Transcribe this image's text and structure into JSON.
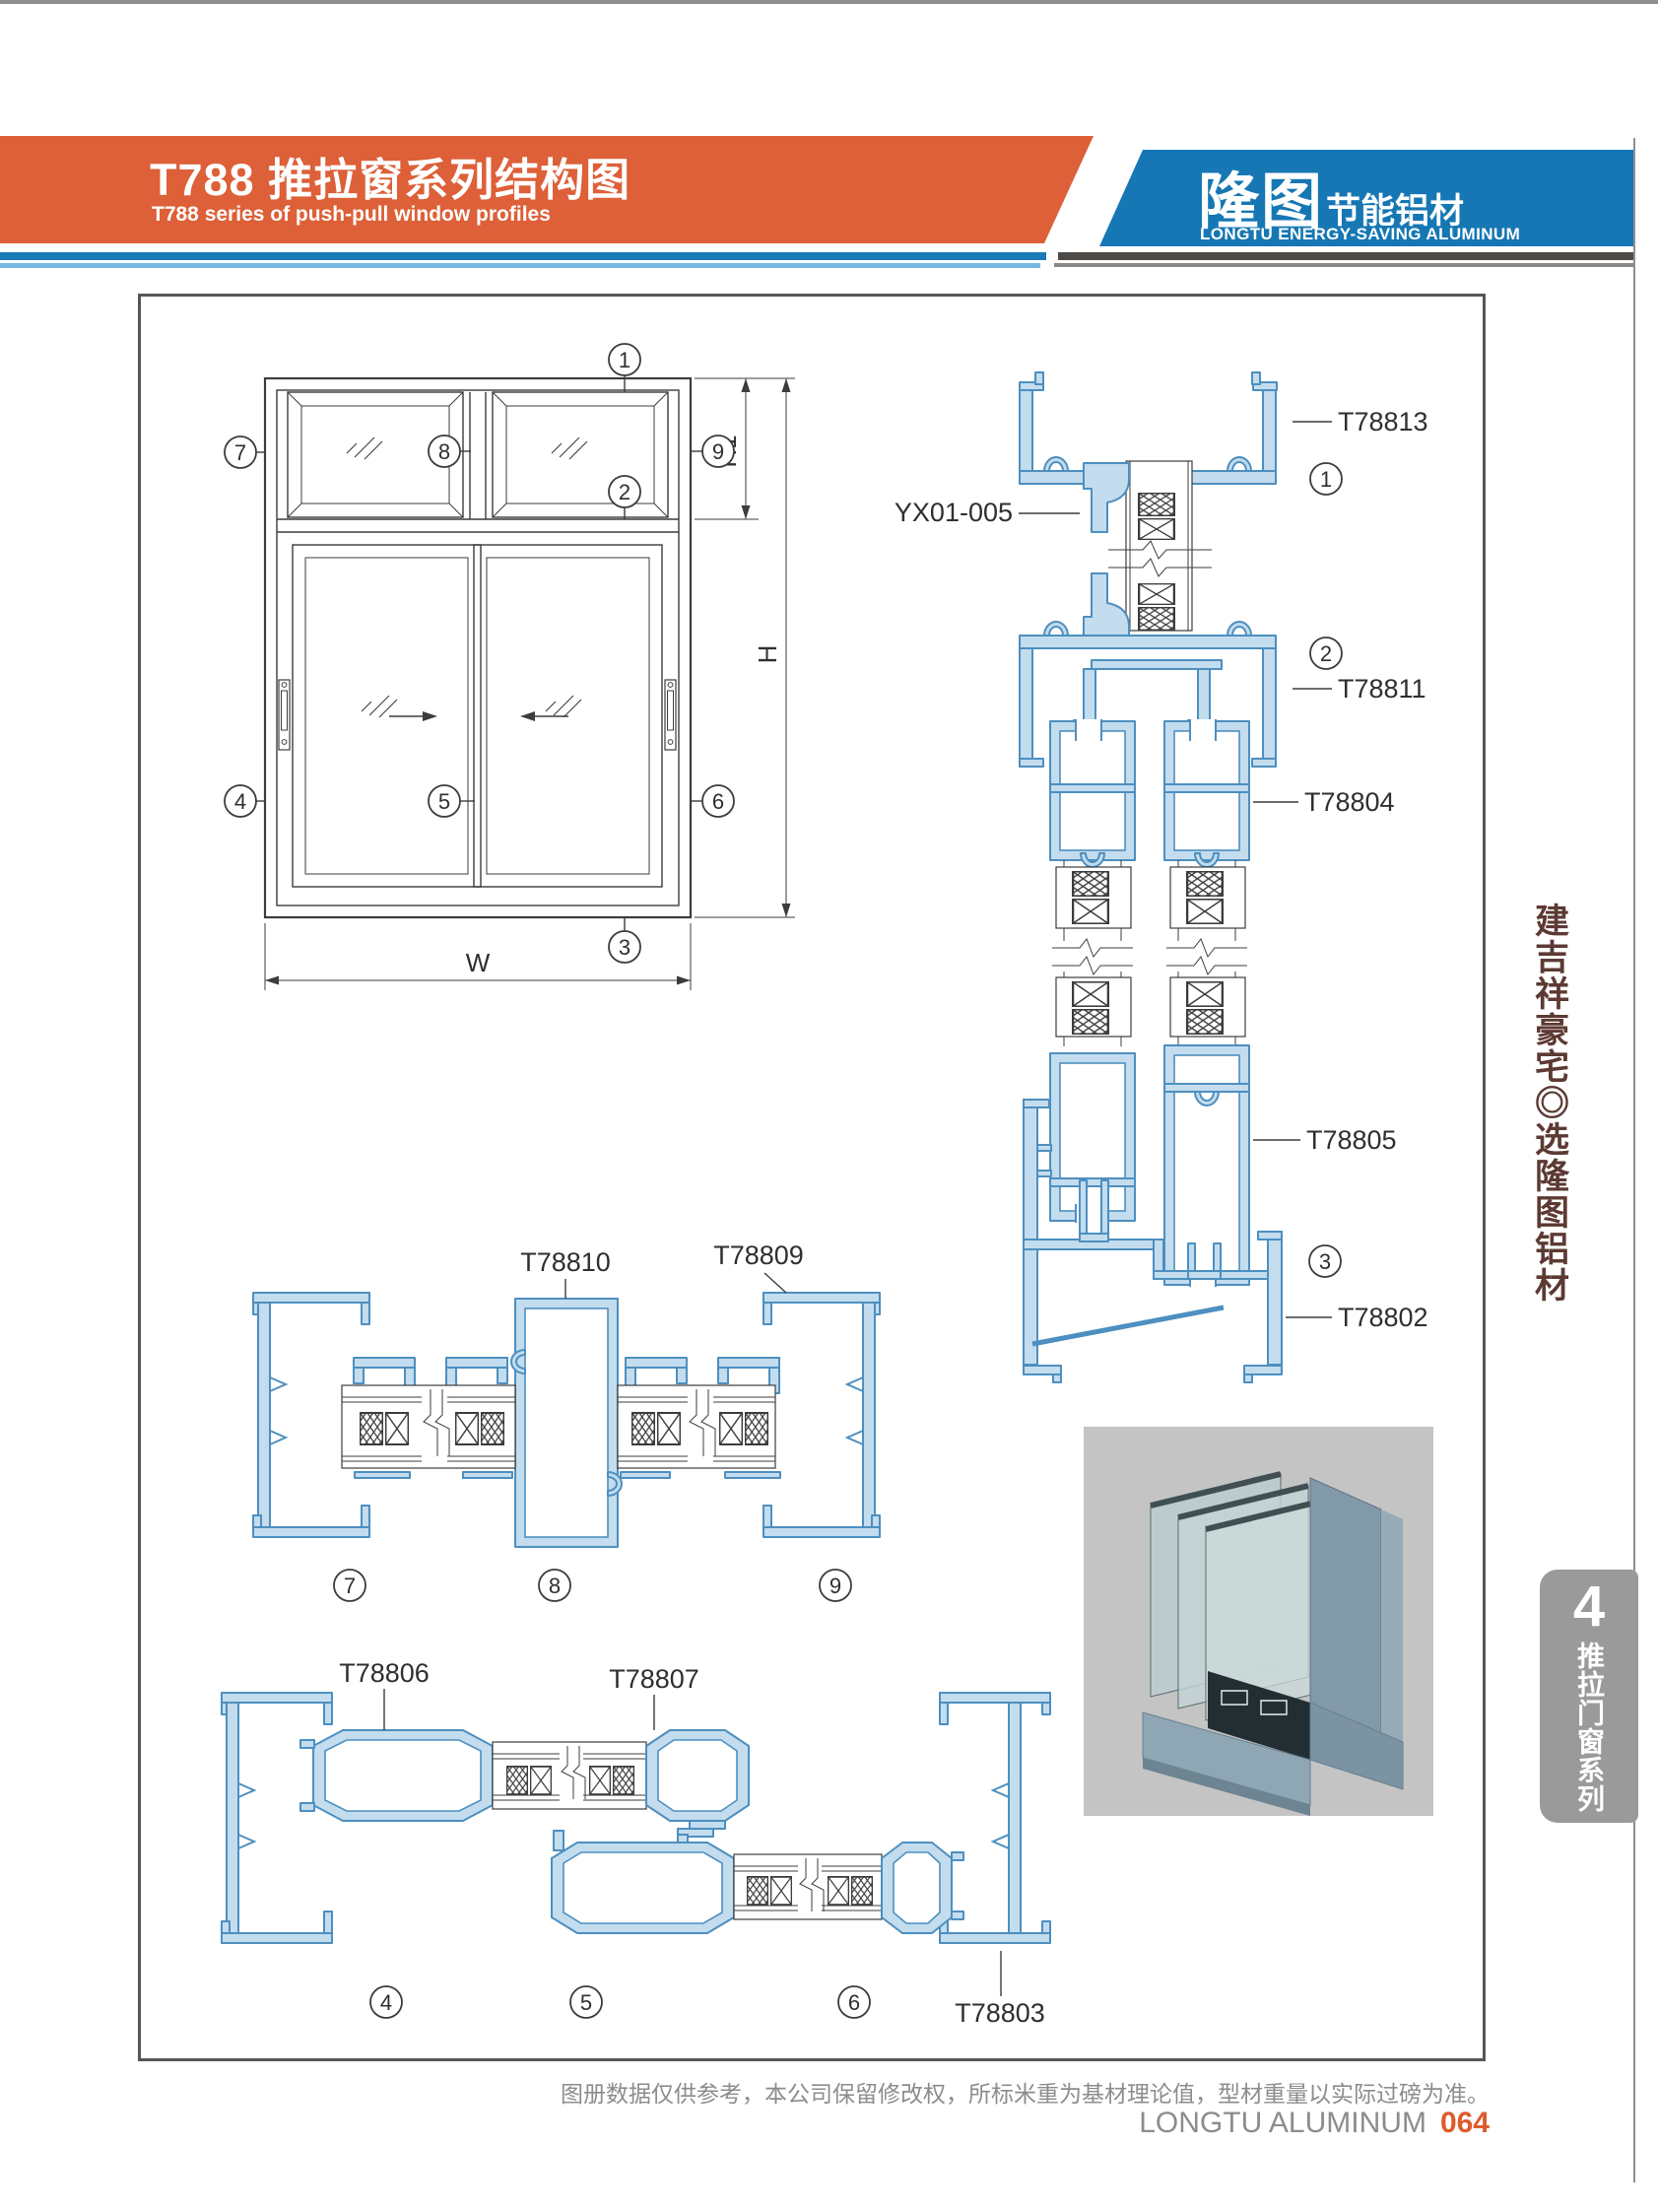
{
  "header": {
    "title": "T788 推拉窗系列结构图",
    "subtitle": "T788 series of push-pull window profiles",
    "brand": "隆图",
    "brand_tag": "节能铝材",
    "brand_en": "LONGTU ENERGY-SAVING ALUMINUM"
  },
  "sidebar": {
    "slogan": "建吉祥豪宅◎选隆图铝材",
    "tab_number": "4",
    "tab_label": "推拉门窗系列"
  },
  "footer": {
    "disclaimer": "图册数据仅供参考，本公司保留修改权，所标米重为基材理论值，型材重量以实际过磅为准。",
    "brand_en": "LONGTU ALUMINUM",
    "page_number": "064"
  },
  "elevation": {
    "dim_w": "W",
    "dim_h": "H",
    "dim_h1": "H1",
    "callouts": {
      "c1": "1",
      "c2": "2",
      "c3": "3",
      "c4": "4",
      "c5": "5",
      "c6": "6",
      "c7": "7",
      "c8": "8",
      "c9": "9"
    }
  },
  "sections": {
    "vertical": {
      "t78813": "T78813",
      "yx": "YX01-005",
      "t78811": "T78811",
      "t78804": "T78804",
      "t78805": "T78805",
      "t78802": "T78802",
      "c1": "1",
      "c2": "2",
      "c3": "3"
    },
    "mid": {
      "t78810": "T78810",
      "t78809": "T78809",
      "c7": "7",
      "c8": "8",
      "c9": "9"
    },
    "bottom": {
      "t78806": "T78806",
      "t78807": "T78807",
      "t78803": "T78803",
      "c4": "4",
      "c5": "5",
      "c6": "6"
    }
  },
  "colors": {
    "accent_orange": "#dd6038",
    "brand_blue": "#1677b4",
    "line_blue_light": "#74b7e2",
    "line_gray_dark": "#4e4a48",
    "profile_fill": "#c3dcee",
    "profile_stroke": "#4d8fc0",
    "drawing_line": "#3c3c3c",
    "slogan_brown": "#5c3a33",
    "tab_gray": "#9a9a9a",
    "page_number_orange": "#dd5b2c"
  }
}
